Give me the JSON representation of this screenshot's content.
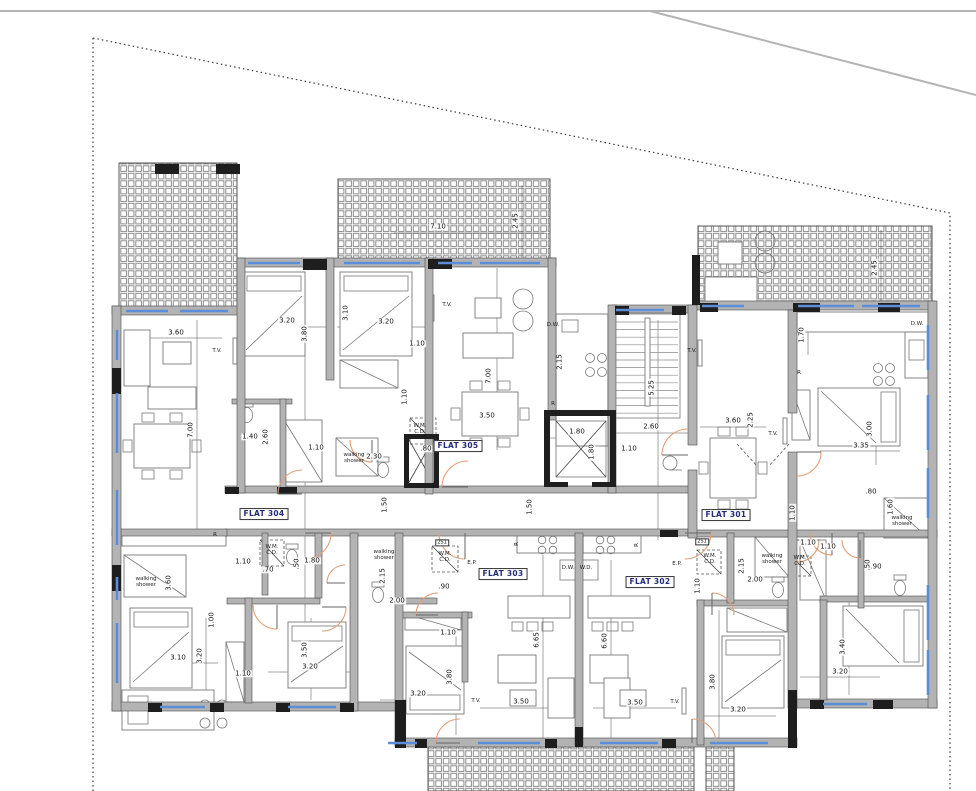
{
  "colors": {
    "wall": "#b3b3b3",
    "wall_dark": "#1e1e1e",
    "window": "#5b8dd9",
    "door": "#e29f76",
    "flat_label_text": "#232a7c",
    "boundary": "#3a3a3a",
    "veranda_grid": "#8d8d8d"
  },
  "labels": [
    {
      "t": "FLAT 304",
      "x": 264,
      "y": 514,
      "k": "flat"
    },
    {
      "t": "FLAT 305",
      "x": 458,
      "y": 446,
      "k": "flat"
    },
    {
      "t": "FLAT 301",
      "x": 726,
      "y": 515,
      "k": "flat"
    },
    {
      "t": "FLAT 303",
      "x": 503,
      "y": 574,
      "k": "flat"
    },
    {
      "t": "FLAT 302",
      "x": 650,
      "y": 582,
      "k": "flat"
    },
    {
      "t": "7.10",
      "x": 438,
      "y": 227,
      "k": "dim"
    },
    {
      "t": "3.60",
      "x": 176,
      "y": 333,
      "k": "dim"
    },
    {
      "t": "3.20",
      "x": 287,
      "y": 321,
      "k": "dim"
    },
    {
      "t": "3.20",
      "x": 386,
      "y": 322,
      "k": "dim"
    },
    {
      "t": "1.10",
      "x": 417,
      "y": 344,
      "k": "dim"
    },
    {
      "t": "1.40",
      "x": 250,
      "y": 437,
      "k": "dim"
    },
    {
      "t": "1.10",
      "x": 316,
      "y": 448,
      "k": "dim"
    },
    {
      "t": "2.30",
      "x": 374,
      "y": 457,
      "k": "dim"
    },
    {
      "t": ".80",
      "x": 426,
      "y": 449,
      "k": "dim"
    },
    {
      "t": "3.50",
      "x": 487,
      "y": 416,
      "k": "dim"
    },
    {
      "t": "1.80",
      "x": 577,
      "y": 432,
      "k": "dim"
    },
    {
      "t": "2.60",
      "x": 651,
      "y": 427,
      "k": "dim"
    },
    {
      "t": "1.10",
      "x": 629,
      "y": 449,
      "k": "dim"
    },
    {
      "t": "3.60",
      "x": 733,
      "y": 421,
      "k": "dim"
    },
    {
      "t": "3.35",
      "x": 861,
      "y": 446,
      "k": "dim"
    },
    {
      "t": "1.10",
      "x": 808,
      "y": 543,
      "k": "dim"
    },
    {
      "t": ".80",
      "x": 871,
      "y": 492,
      "k": "dim"
    },
    {
      "t": "1.10",
      "x": 243,
      "y": 562,
      "k": "dim"
    },
    {
      "t": ".70",
      "x": 268,
      "y": 570,
      "k": "dim"
    },
    {
      "t": "1.80",
      "x": 312,
      "y": 561,
      "k": "dim"
    },
    {
      "t": "2.00",
      "x": 397,
      "y": 601,
      "k": "dim"
    },
    {
      "t": ".90",
      "x": 444,
      "y": 587,
      "k": "dim"
    },
    {
      "t": "3.10",
      "x": 178,
      "y": 658,
      "k": "dim"
    },
    {
      "t": "3.20",
      "x": 310,
      "y": 667,
      "k": "dim"
    },
    {
      "t": "1.10",
      "x": 243,
      "y": 674,
      "k": "dim"
    },
    {
      "t": "3.20",
      "x": 418,
      "y": 694,
      "k": "dim"
    },
    {
      "t": "3.50",
      "x": 521,
      "y": 702,
      "k": "dim"
    },
    {
      "t": "3.50",
      "x": 635,
      "y": 703,
      "k": "dim"
    },
    {
      "t": "1.10",
      "x": 448,
      "y": 633,
      "k": "dim"
    },
    {
      "t": "2.00",
      "x": 755,
      "y": 580,
      "k": "dim"
    },
    {
      "t": "1.10",
      "x": 828,
      "y": 547,
      "k": "dim"
    },
    {
      "t": ".90",
      "x": 876,
      "y": 567,
      "k": "dim"
    },
    {
      "t": "3.20",
      "x": 738,
      "y": 710,
      "k": "dim"
    },
    {
      "t": "3.20",
      "x": 840,
      "y": 672,
      "k": "dim"
    },
    {
      "t": "2.45",
      "x": 516,
      "y": 221,
      "k": "dimv"
    },
    {
      "t": "2.45",
      "x": 875,
      "y": 268,
      "k": "dimv"
    },
    {
      "t": "3.80",
      "x": 305,
      "y": 334,
      "k": "dimv"
    },
    {
      "t": "3.10",
      "x": 346,
      "y": 313,
      "k": "dimv"
    },
    {
      "t": "7.00",
      "x": 191,
      "y": 430,
      "k": "dimv"
    },
    {
      "t": "7.00",
      "x": 489,
      "y": 376,
      "k": "dimv"
    },
    {
      "t": "2.60",
      "x": 266,
      "y": 437,
      "k": "dimv"
    },
    {
      "t": "1.10",
      "x": 405,
      "y": 397,
      "k": "dimv"
    },
    {
      "t": "2.15",
      "x": 560,
      "y": 362,
      "k": "dimv"
    },
    {
      "t": "5.25",
      "x": 652,
      "y": 388,
      "k": "dimv"
    },
    {
      "t": "1.80",
      "x": 592,
      "y": 452,
      "k": "dimv"
    },
    {
      "t": "1.50",
      "x": 385,
      "y": 505,
      "k": "dimv"
    },
    {
      "t": "1.50",
      "x": 530,
      "y": 507,
      "k": "dimv"
    },
    {
      "t": "1.70",
      "x": 802,
      "y": 335,
      "k": "dimv"
    },
    {
      "t": "2.25",
      "x": 751,
      "y": 420,
      "k": "dimv"
    },
    {
      "t": "3.00",
      "x": 870,
      "y": 429,
      "k": "dimv"
    },
    {
      "t": "1.10",
      "x": 793,
      "y": 513,
      "k": "dimv"
    },
    {
      "t": "1.60",
      "x": 891,
      "y": 507,
      "k": "dimv"
    },
    {
      "t": ".50",
      "x": 297,
      "y": 564,
      "k": "dimv"
    },
    {
      "t": "3.60",
      "x": 169,
      "y": 583,
      "k": "dimv"
    },
    {
      "t": "1.00",
      "x": 212,
      "y": 620,
      "k": "dimv"
    },
    {
      "t": "3.20",
      "x": 200,
      "y": 656,
      "k": "dimv"
    },
    {
      "t": "3.50",
      "x": 305,
      "y": 650,
      "k": "dimv"
    },
    {
      "t": "2.15",
      "x": 383,
      "y": 576,
      "k": "dimv"
    },
    {
      "t": "6.65",
      "x": 537,
      "y": 640,
      "k": "dimv"
    },
    {
      "t": "6.60",
      "x": 605,
      "y": 641,
      "k": "dimv"
    },
    {
      "t": "3.80",
      "x": 450,
      "y": 677,
      "k": "dimv"
    },
    {
      "t": "3.80",
      "x": 713,
      "y": 682,
      "k": "dimv"
    },
    {
      "t": "3.40",
      "x": 843,
      "y": 647,
      "k": "dimv"
    },
    {
      "t": "1.10",
      "x": 698,
      "y": 586,
      "k": "dimv"
    },
    {
      "t": "2.15",
      "x": 742,
      "y": 566,
      "k": "dimv"
    },
    {
      "t": ".50",
      "x": 868,
      "y": 565,
      "k": "dimv"
    },
    {
      "t": "T.V.",
      "x": 217,
      "y": 352,
      "k": "note"
    },
    {
      "t": "T.V.",
      "x": 447,
      "y": 306,
      "k": "note"
    },
    {
      "t": "T.V.",
      "x": 692,
      "y": 352,
      "k": "note"
    },
    {
      "t": "T.V.",
      "x": 773,
      "y": 435,
      "k": "note"
    },
    {
      "t": "T.V.",
      "x": 476,
      "y": 702,
      "k": "note"
    },
    {
      "t": "T.V.",
      "x": 675,
      "y": 703,
      "k": "note"
    },
    {
      "t": "walking\nshower",
      "x": 354,
      "y": 459,
      "k": "note"
    },
    {
      "t": "walking\nshower",
      "x": 146,
      "y": 583,
      "k": "note"
    },
    {
      "t": "walking\nshower",
      "x": 384,
      "y": 556,
      "k": "note"
    },
    {
      "t": "walking\nshower",
      "x": 902,
      "y": 522,
      "k": "note"
    },
    {
      "t": "walking\nshower",
      "x": 772,
      "y": 560,
      "k": "note"
    },
    {
      "t": "W.M.\nC.D.",
      "x": 420,
      "y": 430,
      "k": "note"
    },
    {
      "t": "W.M.\nC.D.",
      "x": 272,
      "y": 551,
      "k": "note"
    },
    {
      "t": "W.M.\nC.D.",
      "x": 445,
      "y": 558,
      "k": "note"
    },
    {
      "t": "W.M.\nC.D.",
      "x": 800,
      "y": 562,
      "k": "note"
    },
    {
      "t": "W.M.\nC.D.",
      "x": 710,
      "y": 560,
      "k": "note"
    },
    {
      "t": "D.W.",
      "x": 553,
      "y": 326,
      "k": "note"
    },
    {
      "t": "D.W.",
      "x": 917,
      "y": 325,
      "k": "note"
    },
    {
      "t": "D.W.",
      "x": 568,
      "y": 569,
      "k": "note"
    },
    {
      "t": "W.D.",
      "x": 586,
      "y": 569,
      "k": "note"
    },
    {
      "t": "E.P.",
      "x": 472,
      "y": 564,
      "k": "note"
    },
    {
      "t": "E.P.",
      "x": 677,
      "y": 565,
      "k": "note"
    },
    {
      "t": "R",
      "x": 215,
      "y": 536,
      "k": "note"
    },
    {
      "t": "R",
      "x": 553,
      "y": 405,
      "k": "note"
    },
    {
      "t": "R",
      "x": 799,
      "y": 374,
      "k": "note"
    },
    {
      "t": "R",
      "x": 518,
      "y": 544,
      "k": "notev"
    },
    {
      "t": "R",
      "x": 638,
      "y": 545,
      "k": "notev"
    },
    {
      "t": "2S1",
      "x": 442,
      "y": 543,
      "k": "tag"
    },
    {
      "t": "2S1",
      "x": 702,
      "y": 542,
      "k": "tag"
    }
  ]
}
